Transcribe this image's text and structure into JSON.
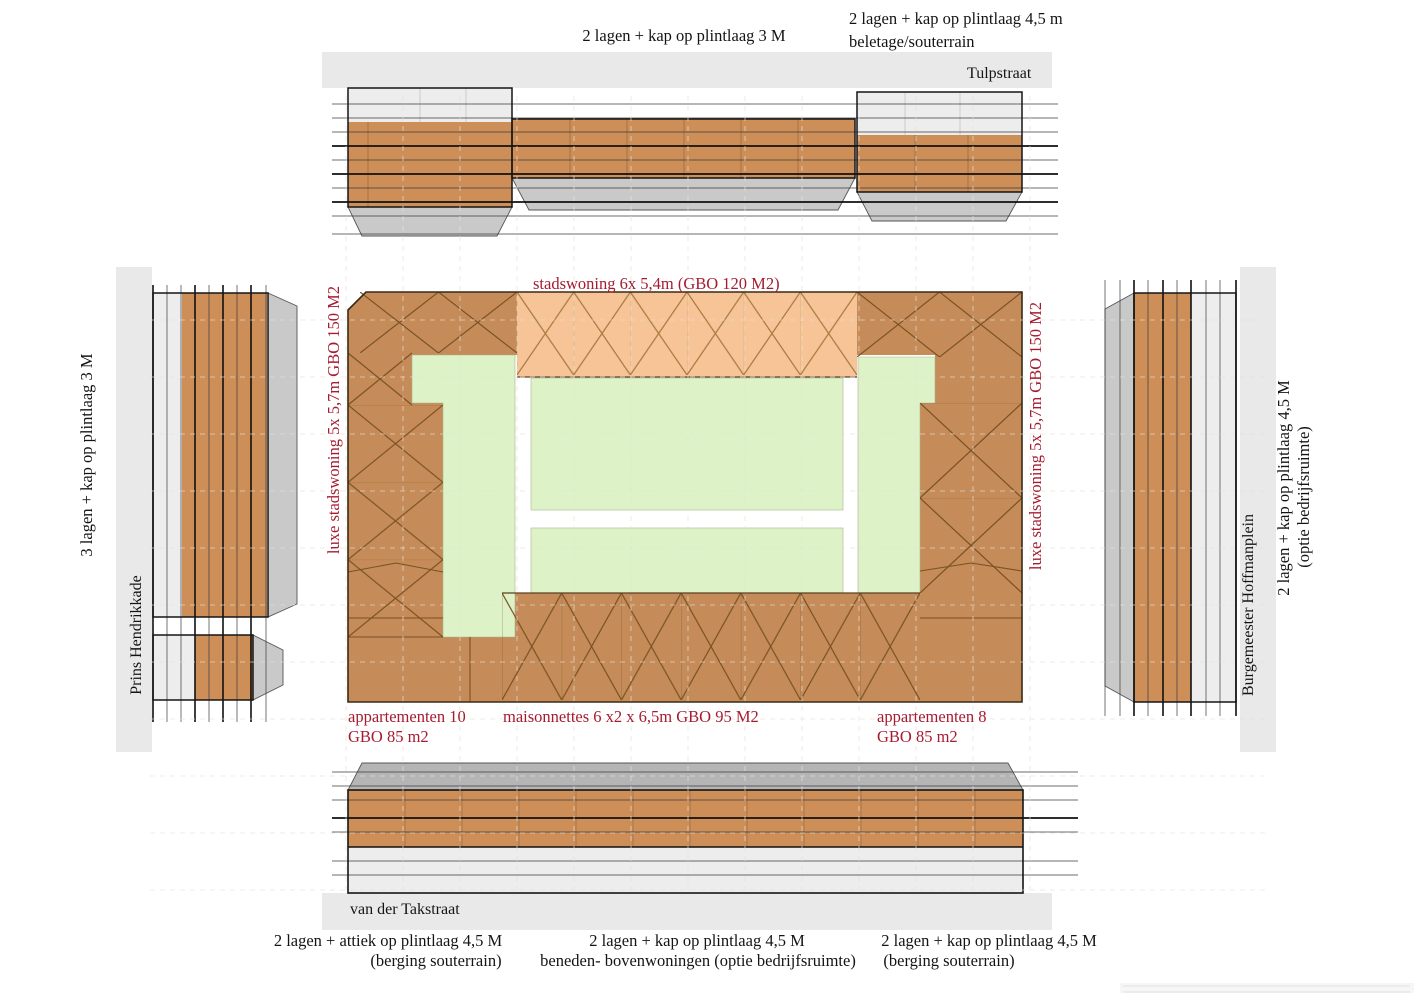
{
  "title": "stedenbouwkundig blokdiagram",
  "streets": {
    "top": "Tulpstraat",
    "bottom": "van der Takstraat",
    "left": "Prins Hendrikkade",
    "right": "Burgemeester Hoffmanplein"
  },
  "elevation_labels": {
    "top_center": "2 lagen + kap op plintlaag 3 M",
    "top_right_line1": "2 lagen + kap op plintlaag 4,5 m",
    "top_right_line2": "beletage/souterrain",
    "left": "3 lagen + kap op plintlaag 3 M",
    "right_line1": "2 lagen + kap op plintlaag 4,5 M",
    "right_line2": "(optie bedrijfsruimte)",
    "bottom_left_line1": "2 lagen + attiek op plintlaag 4,5 M",
    "bottom_left_line2": "(berging souterrain)",
    "bottom_center_line1": "2 lagen + kap op plintlaag 4,5 M",
    "bottom_center_line2": "beneden- bovenwoningen (optie bedrijfsruimte)",
    "bottom_right_line1": "2 lagen + kap op plintlaag 4,5 M",
    "bottom_right_line2": "(berging souterrain)"
  },
  "unit_labels": {
    "stadswoning": "stadswoning 6x 5,4m (GBO 120 M2)",
    "luxe_left": "luxe stadswoning 5x 5,7m GBO 150 M2",
    "luxe_right": "luxe stadswoning 5x 5,7m GBO 150 M2",
    "app10_line1": "appartementen 10",
    "app10_line2": "GBO 85 m2",
    "maisonnettes": "maisonnettes 6 x2 x 6,5m GBO 95 M2",
    "app8_line1": "appartementen 8",
    "app8_line2": "GBO 85 m2"
  },
  "colors": {
    "plan_brown": "#c58b58",
    "plan_brown_line": "#7a5224",
    "peach": "#f6c496",
    "peach_line": "#a8793f",
    "courtyard_green": "#def2c8",
    "elevation_orange": "#cd8e58",
    "elevation_light_gray": "#ededed",
    "roof_gray": "#c9c9c9",
    "roof_gray_dark": "#b5b5b5",
    "street_band_gray": "#e9e9e9",
    "red_label": "#a51c30",
    "black_label": "#141414"
  }
}
